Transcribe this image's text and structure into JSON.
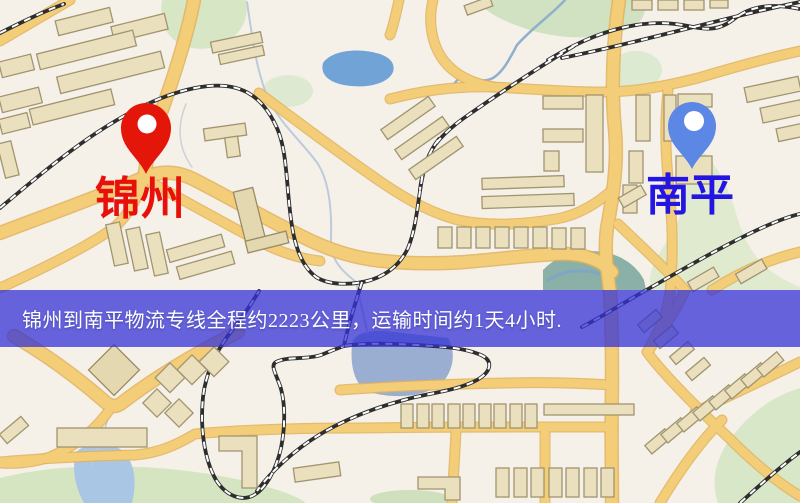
{
  "window": {
    "width": 800,
    "height": 503
  },
  "map": {
    "origin": {
      "name": "锦州"
    },
    "destination": {
      "name": "南平"
    },
    "route_banner": "锦州到南平物流专线全程约2223公里，运输时间约1天4小时."
  },
  "colors": {
    "origin_text": "#e8100b",
    "destination_text": "#2315e2",
    "origin_pin": "#eb1407",
    "destination_pin": "#5b87e8",
    "pin_hole": "#ffffff",
    "banner_bg": "rgba(52,50,214,0.75)",
    "banner_text": "#ffffff",
    "background": "#f5f1e9",
    "road": "#f6cd74",
    "building": "#ebe0bc",
    "park": "#d7e6c3",
    "water": "#6fa3d8",
    "railway": "#2e2e2e"
  }
}
